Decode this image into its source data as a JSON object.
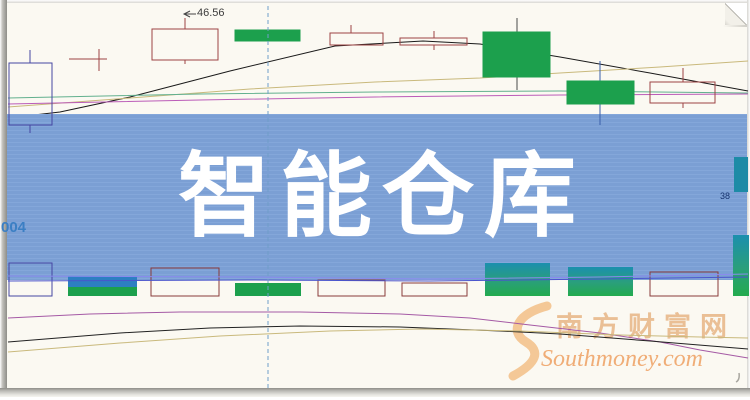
{
  "banner": {
    "title": "智能仓库",
    "bg_color": "#7da2d8",
    "text_color": "#ffffff"
  },
  "labels": {
    "price_high": "46.56",
    "code_fragment": "004",
    "right_fragment": "38"
  },
  "watermark": {
    "cn": "南方财富网",
    "en": "Southmoney.com",
    "color": "#eabf95"
  },
  "chart_data": {
    "type": "candlestick",
    "title": "智能仓库",
    "axes_visible": false,
    "note": "daily K-line with MA overlays, volume pane and lower indicator pane; coordinates are pixel-space estimates, only price label visible is 46.56",
    "colors": {
      "up_hollow_border": "#9c4444",
      "first_candle_border": "#4646a2",
      "down_fill": "#1ca04d",
      "gradient_top": "#1b8fae",
      "gradient_bottom": "#23ab4e",
      "stacked_blue": "#2d7fc2",
      "dashed_line": "#6f9ec9",
      "teal_tag": "#1d8ba6"
    },
    "candles": [
      {
        "x1": 9,
        "x2": 52,
        "cx": 30,
        "top": 63,
        "bottom": 125,
        "wick_top": 50,
        "wick_bottom": 133,
        "kind": "hollow",
        "border": "#4646a2"
      },
      {
        "x1": 69,
        "x2": 107,
        "cx": 99,
        "top": 59,
        "bottom": 59,
        "wick_top": 49,
        "wick_bottom": 71,
        "kind": "doji",
        "border": "#9c4444"
      },
      {
        "x1": 152,
        "x2": 218,
        "cx": 185,
        "top": 29,
        "bottom": 60,
        "wick_top": 18,
        "wick_bottom": 64,
        "kind": "hollow",
        "border": "#9c4444"
      },
      {
        "x1": 235,
        "x2": 300,
        "cx": 267,
        "top": 30,
        "bottom": 41,
        "wick_top": 30,
        "wick_bottom": 41,
        "kind": "solid"
      },
      {
        "x1": 330,
        "x2": 383,
        "cx": 351,
        "top": 33,
        "bottom": 45,
        "wick_top": 25,
        "wick_bottom": 45,
        "kind": "hollow",
        "border": "#9c4444"
      },
      {
        "x1": 400,
        "x2": 467,
        "cx": 434,
        "top": 38,
        "bottom": 45,
        "wick_top": 31,
        "wick_bottom": 50,
        "kind": "hollow",
        "border": "#9c4444"
      },
      {
        "x1": 483,
        "x2": 550,
        "cx": 517,
        "top": 32,
        "bottom": 77,
        "wick_top": 18,
        "wick_bottom": 90,
        "kind": "solid",
        "wick": "#4a4a4a"
      },
      {
        "x1": 567,
        "x2": 634,
        "cx": 600,
        "top": 81,
        "bottom": 104,
        "wick_top": 61,
        "wick_bottom": 125,
        "kind": "solid",
        "wick": "#3a5faa"
      },
      {
        "x1": 650,
        "x2": 715,
        "cx": 683,
        "top": 82,
        "bottom": 103,
        "wick_top": 68,
        "wick_bottom": 108,
        "kind": "hollow",
        "border": "#9c4444"
      }
    ],
    "volume_bars": [
      {
        "x1": 9,
        "x2": 52,
        "top": 263,
        "bottom": 296,
        "kind": "hollow",
        "border": "#4646a2"
      },
      {
        "x1": 68,
        "x2": 137,
        "top": 276,
        "bottom": 296,
        "kind": "stacked",
        "split": 287
      },
      {
        "x1": 151,
        "x2": 219,
        "top": 268,
        "bottom": 296,
        "kind": "hollow",
        "border": "#8a3a3a"
      },
      {
        "x1": 235,
        "x2": 301,
        "top": 283,
        "bottom": 296,
        "kind": "green"
      },
      {
        "x1": 318,
        "x2": 385,
        "top": 280,
        "bottom": 296,
        "kind": "hollow",
        "border": "#8a3a3a"
      },
      {
        "x1": 402,
        "x2": 467,
        "top": 283,
        "bottom": 296,
        "kind": "hollow",
        "border": "#8a3a3a"
      },
      {
        "x1": 485,
        "x2": 550,
        "top": 263,
        "bottom": 296,
        "kind": "gradient"
      },
      {
        "x1": 568,
        "x2": 633,
        "top": 267,
        "bottom": 296,
        "kind": "gradient"
      },
      {
        "x1": 650,
        "x2": 718,
        "top": 272,
        "bottom": 296,
        "kind": "hollow",
        "border": "#8a3a3a"
      },
      {
        "x1": 733,
        "x2": 749,
        "top": 235,
        "bottom": 296,
        "kind": "gradient"
      }
    ],
    "teal_tag_rect": {
      "x": 734,
      "y": 157,
      "w": 14,
      "h": 35
    },
    "dashed_vline": {
      "x": 268,
      "y1": 6,
      "y2": 388
    },
    "lines_under": [
      {
        "name": "ma-black",
        "color": "#1a1a1a",
        "points": [
          [
            8,
            118
          ],
          [
            60,
            112
          ],
          [
            130,
            97
          ],
          [
            230,
            71
          ],
          [
            335,
            46
          ],
          [
            423,
            41
          ],
          [
            480,
            44
          ],
          [
            560,
            57
          ],
          [
            650,
            73
          ],
          [
            748,
            91
          ]
        ]
      },
      {
        "name": "ma-yellow",
        "color": "#c9b97c",
        "points": [
          [
            8,
            107
          ],
          [
            130,
            98
          ],
          [
            250,
            89
          ],
          [
            375,
            82
          ],
          [
            480,
            78
          ],
          [
            560,
            73
          ],
          [
            660,
            67
          ],
          [
            748,
            61
          ]
        ]
      },
      {
        "name": "ma-green",
        "color": "#62b08e",
        "points": [
          [
            8,
            98
          ],
          [
            200,
            94
          ],
          [
            375,
            92
          ],
          [
            560,
            91
          ],
          [
            748,
            93
          ]
        ]
      },
      {
        "name": "ma-magenta",
        "color": "#bb5cb8",
        "points": [
          [
            8,
            104
          ],
          [
            200,
            100
          ],
          [
            375,
            97
          ],
          [
            560,
            95
          ],
          [
            748,
            94
          ]
        ]
      },
      {
        "name": "ma-blue",
        "color": "#2a35c0",
        "points": [
          [
            8,
            118
          ],
          [
            40,
            120
          ],
          [
            70,
            124
          ]
        ]
      },
      {
        "name": "low-magenta",
        "color": "#a55aa5",
        "points": [
          [
            8,
            318
          ],
          [
            90,
            314
          ],
          [
            180,
            312
          ],
          [
            300,
            312
          ],
          [
            400,
            314
          ],
          [
            470,
            318
          ],
          [
            530,
            325
          ],
          [
            600,
            333
          ],
          [
            660,
            342
          ],
          [
            700,
            350
          ],
          [
            748,
            358
          ]
        ]
      },
      {
        "name": "low-black",
        "color": "#222222",
        "points": [
          [
            8,
            342
          ],
          [
            120,
            333
          ],
          [
            210,
            328
          ],
          [
            300,
            326
          ],
          [
            400,
            327
          ],
          [
            500,
            331
          ],
          [
            560,
            334
          ],
          [
            650,
            341
          ],
          [
            748,
            349
          ]
        ]
      },
      {
        "name": "low-yellow",
        "color": "#c9b97c",
        "points": [
          [
            8,
            352
          ],
          [
            120,
            343
          ],
          [
            220,
            336
          ],
          [
            330,
            331
          ],
          [
            420,
            329
          ],
          [
            520,
            331
          ],
          [
            620,
            335
          ],
          [
            700,
            337
          ],
          [
            748,
            338
          ]
        ]
      }
    ],
    "lines_over": [
      {
        "name": "vol-ma-light",
        "color": "#8a8aee",
        "points": [
          [
            8,
            276
          ],
          [
            250,
            277
          ],
          [
            430,
            279
          ],
          [
            600,
            277
          ],
          [
            748,
            274
          ]
        ]
      },
      {
        "name": "vol-ma-dark",
        "color": "#4a55cc",
        "points": [
          [
            8,
            281
          ],
          [
            250,
            280
          ],
          [
            430,
            281
          ],
          [
            600,
            279
          ],
          [
            748,
            277
          ]
        ]
      }
    ],
    "price_marker": {
      "text": "46.56",
      "tick": [
        [
          196,
          14
        ],
        [
          184,
          14
        ]
      ],
      "arrow": "M190,11 L184,14 L190,17"
    }
  }
}
